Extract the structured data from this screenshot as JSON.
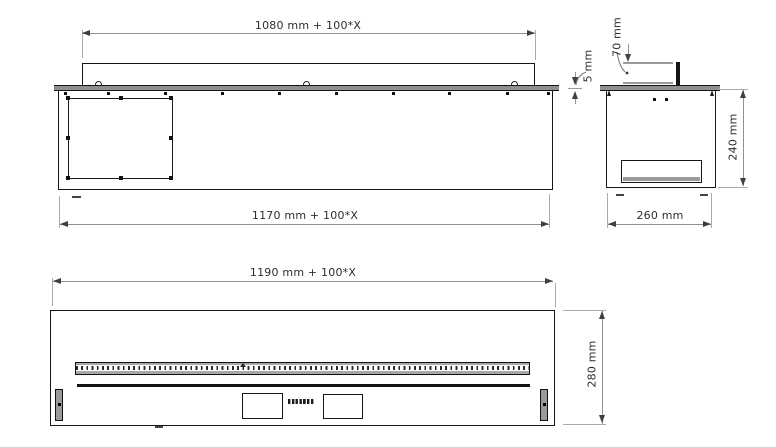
{
  "page": {
    "type": "technical-drawing",
    "background": "#ffffff"
  },
  "colors": {
    "object_line": "#161616",
    "dimension_line": "#8f8f8f",
    "arrow": "#3f3f3f",
    "metal_fill": "#909090",
    "text": "#2e2e2e"
  },
  "views": {
    "side": {
      "name": "side-view",
      "dimensions": {
        "lid_width": "1080 mm + 100*X",
        "body_width": "1170 mm + 100*X"
      }
    },
    "section": {
      "name": "end-section-view",
      "dimensions": {
        "flange_thickness": "5 mm",
        "top_offset": "70 mm",
        "body_height": "240 mm",
        "body_depth": "260 mm"
      }
    },
    "front": {
      "name": "front-view",
      "dimensions": {
        "body_width": "1190 mm + 100*X",
        "body_height": "280 mm"
      },
      "brand_wordmark_visible": true
    }
  }
}
